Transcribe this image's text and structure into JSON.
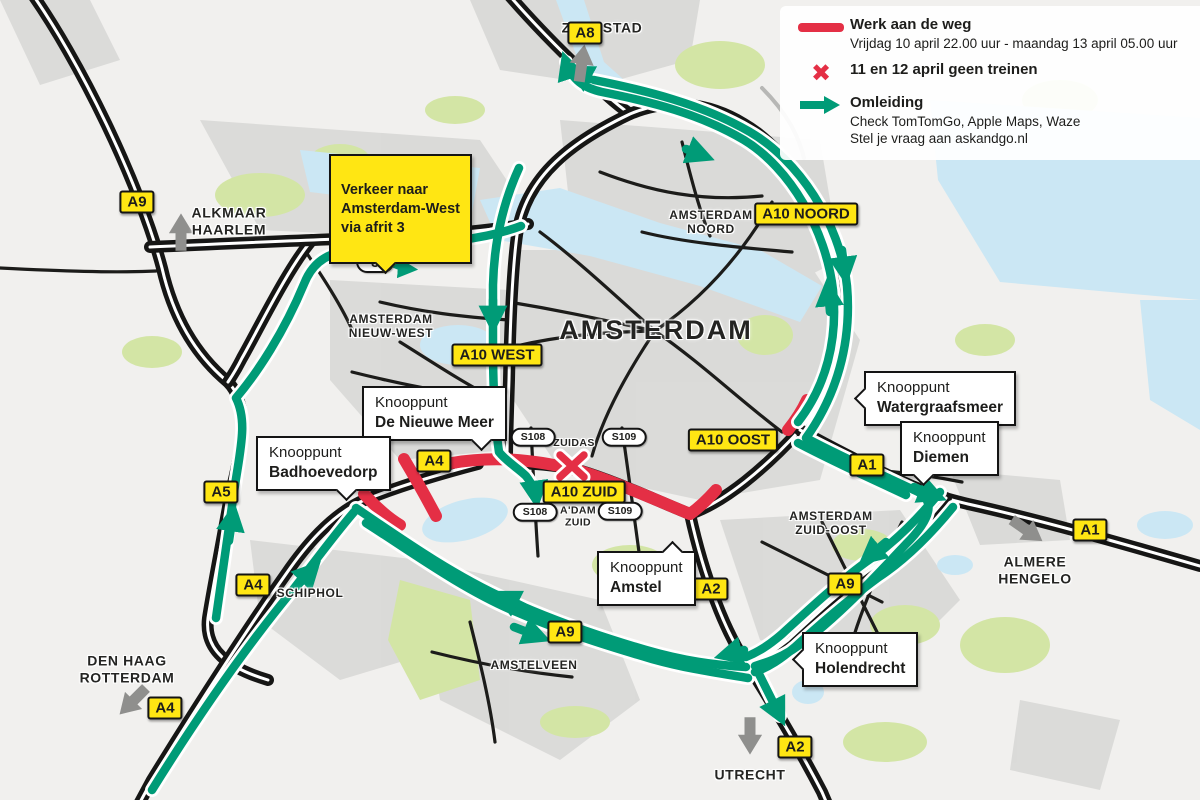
{
  "legend": {
    "roadwork_title": "Werk aan de weg",
    "roadwork_dates": "Vrijdag 10 april 22.00 uur - maandag 13 april 05.00 uur",
    "trains_title": "11 en 12 april geen treinen",
    "detour_title": "Omleiding",
    "detour_line1": "Check TomTomGo, Apple Maps, Waze",
    "detour_line2": "Stel je vraag aan askandgo.nl",
    "x_glyph": "✖"
  },
  "note": {
    "text": "Verkeer naar\nAmsterdam-West\nvia afrit 3"
  },
  "colors": {
    "roadwork_red": "#e42f45",
    "detour_green": "#009b77",
    "shield_yellow": "#ffe613",
    "road_black": "#161615",
    "water_blue": "#cbe7f4",
    "park_green": "#d3e5a5",
    "urban_gray": "#d8d8d6"
  },
  "shields": {
    "a8": "A8",
    "a9_nw": "A9",
    "a5_top": "A5",
    "a5_west": "A5",
    "a10_noord": "A10 NOORD",
    "a10_west": "A10 WEST",
    "a10_oost": "A10 OOST",
    "a10_zuid": "A10 ZUID",
    "a1_mid": "A1",
    "a1_east": "A1",
    "a4_ring": "A4",
    "a4_schiphol": "A4",
    "a4_sw": "A4",
    "a2_mid": "A2",
    "a2_south": "A2",
    "a9_zuidoost": "A9",
    "a9_amstelveen": "A9",
    "s108": "S108",
    "s109": "S109",
    "exit3": "3"
  },
  "places": {
    "zaanstad": "ZAANSTAD",
    "alkmaar": "ALKMAAR\nHAARLEM",
    "amsterdam": "AMSTERDAM",
    "noord": "AMSTERDAM\nNOORD",
    "nieuw_west": "AMSTERDAM\nNIEUW-WEST",
    "zuidas": "ZUIDAS",
    "adam_zuid": "A'DAM\nZUID",
    "zuid_oost": "AMSTERDAM\nZUID-OOST",
    "schiphol": "SCHIPHOL",
    "amstelveen": "AMSTELVEEN",
    "den_haag": "DEN HAAG\nROTTERDAM",
    "almere": "ALMERE\nHENGELO",
    "utrecht": "UTRECHT"
  },
  "junctions": [
    {
      "prefix": "Knooppunt",
      "name": "De Nieuwe Meer"
    },
    {
      "prefix": "Knooppunt",
      "name": "Badhoevedorp"
    },
    {
      "prefix": "Knooppunt",
      "name": "Watergraafsmeer"
    },
    {
      "prefix": "Knooppunt",
      "name": "Diemen"
    },
    {
      "prefix": "Knooppunt",
      "name": "Amstel"
    },
    {
      "prefix": "Knooppunt",
      "name": "Holendrecht"
    }
  ]
}
